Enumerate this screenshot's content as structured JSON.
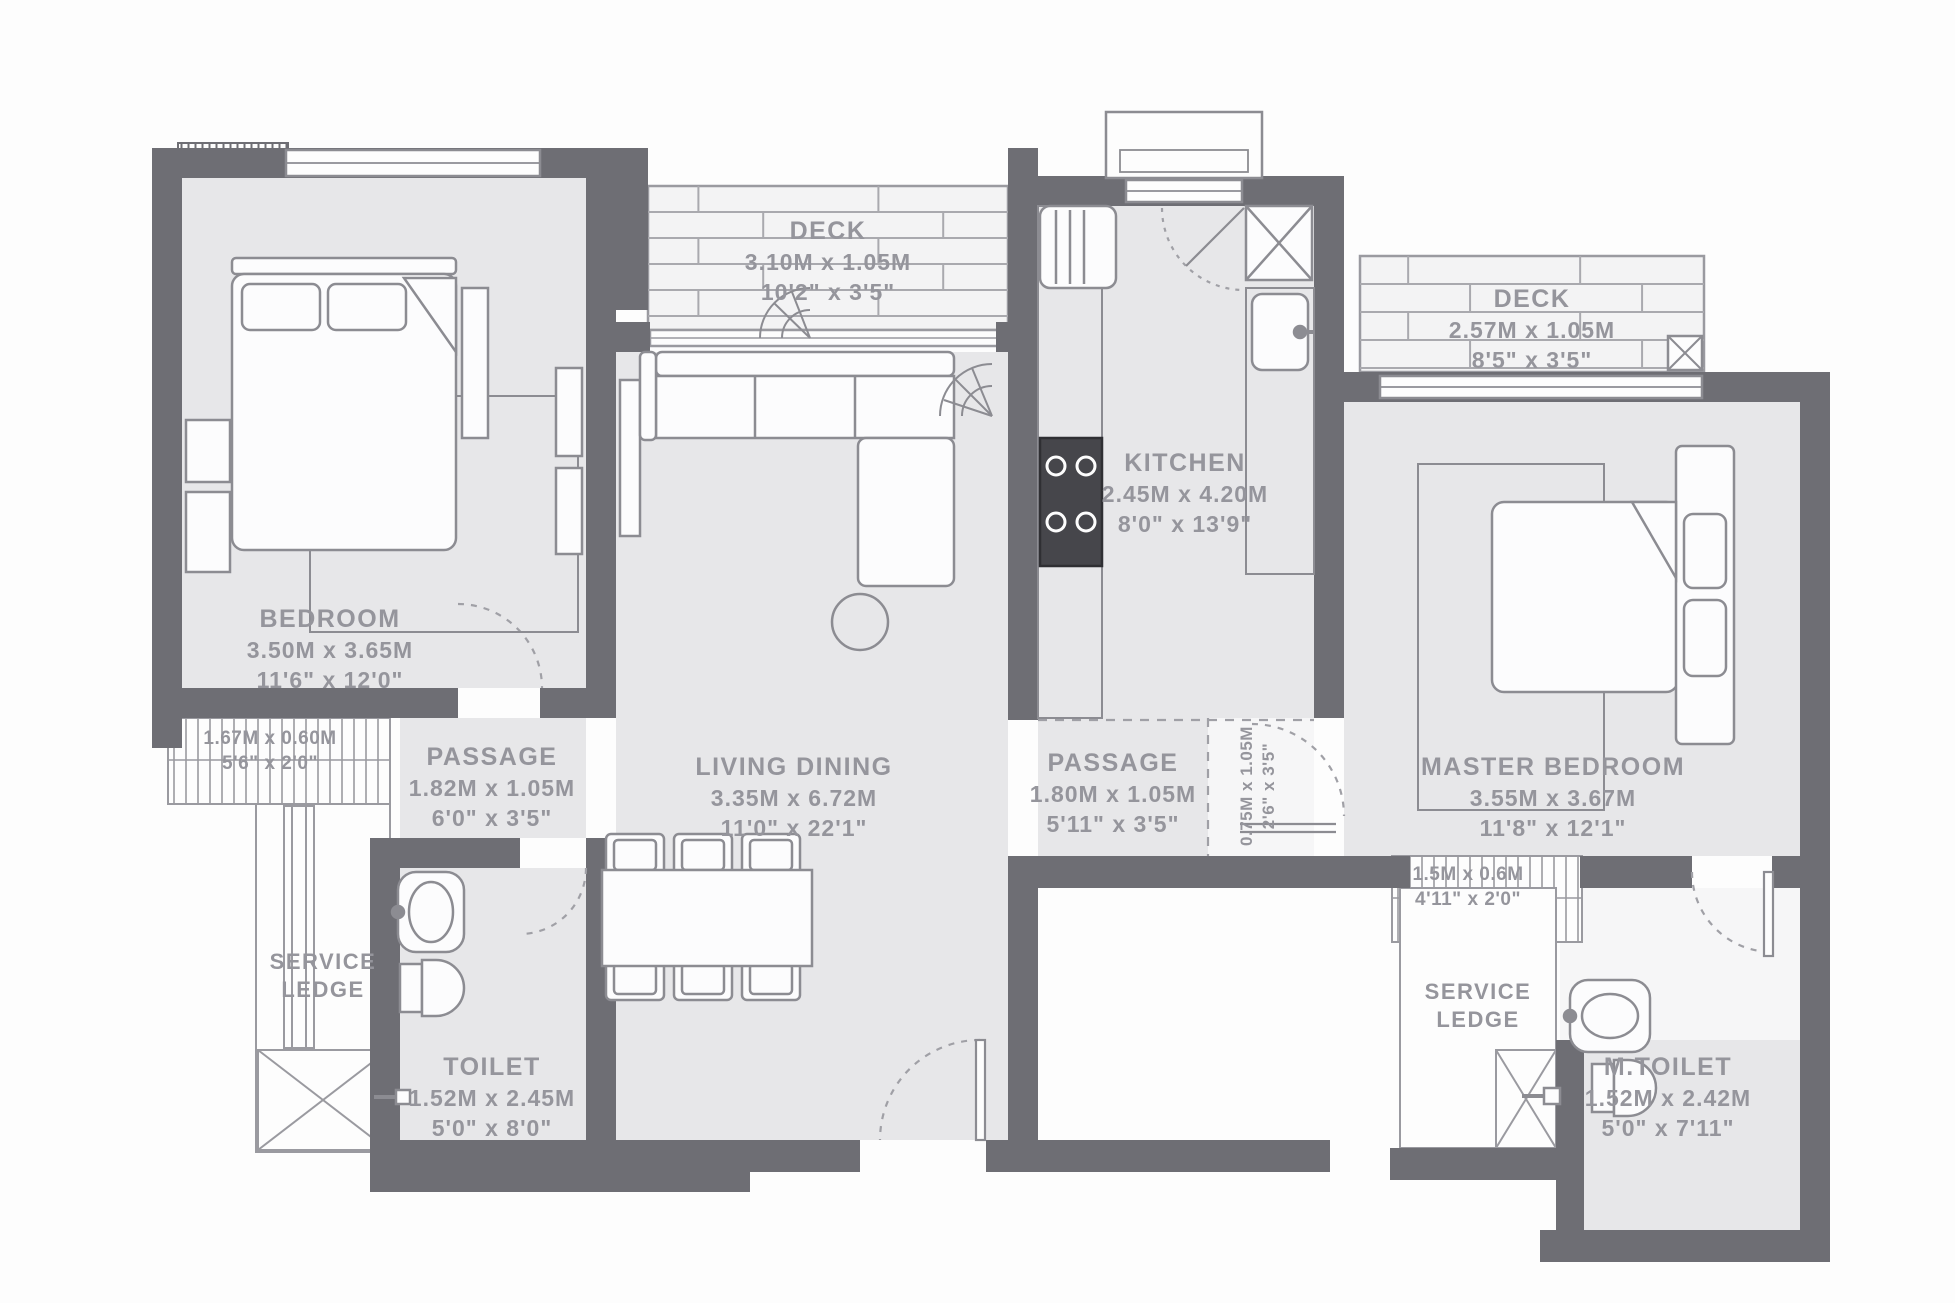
{
  "rooms": {
    "bedroom": {
      "name": "BEDROOM",
      "metric": "3.50M x 3.65M",
      "imperial": "11'6\" x 12'0\""
    },
    "deck_left": {
      "name": "DECK",
      "metric": "3.10M x 1.05M",
      "imperial": "10'2\" x 3'5\""
    },
    "kitchen": {
      "name": "KITCHEN",
      "metric": "2.45M x 4.20M",
      "imperial": "8'0\" x 13'9\""
    },
    "deck_right": {
      "name": "DECK",
      "metric": "2.57M x 1.05M",
      "imperial": "8'5\" x 3'5\""
    },
    "living_dining": {
      "name": "LIVING DINING",
      "metric": "3.35M x 6.72M",
      "imperial": "11'0\" x 22'1\""
    },
    "passage_left": {
      "name": "PASSAGE",
      "metric": "1.82M x 1.05M",
      "imperial": "6'0\" x 3'5\""
    },
    "passage_right": {
      "name": "PASSAGE",
      "metric": "1.80M x 1.05M",
      "imperial": "5'11\" x 3'5\""
    },
    "master_bedroom": {
      "name": "MASTER BEDROOM",
      "metric": "3.55M x 3.67M",
      "imperial": "11'8\" x 12'1\""
    },
    "toilet": {
      "name": "TOILET",
      "metric": "1.52M x 2.45M",
      "imperial": "5'0\" x 8'0\""
    },
    "m_toilet": {
      "name": "M.TOILET",
      "metric": "1.52M x 2.42M",
      "imperial": "5'0\" x 7'11\""
    },
    "service_ledge_left": {
      "line1": "SERVICE",
      "line2": "LEDGE"
    },
    "service_ledge_right": {
      "line1": "SERVICE",
      "line2": "LEDGE"
    },
    "ledge_left": {
      "metric": "1.67M x 0.60M",
      "imperial": "5'6\" x 2'0\""
    },
    "ledge_right": {
      "metric": "1.5M x 0.6M",
      "imperial": "4'11\" x 2'0\""
    },
    "foyer": {
      "metric": "0.75M x 1.05M",
      "imperial": "2'6\" x 3'5\""
    }
  },
  "colors": {
    "wall": "#6e6e74",
    "room_fill": "#e7e7e9",
    "white": "#fdfdfd",
    "outline": "#9a9aa0",
    "furniture": "#8c8c92",
    "deck_line": "#a9a9ae",
    "text": "#95959c",
    "stove": "#46464b"
  }
}
